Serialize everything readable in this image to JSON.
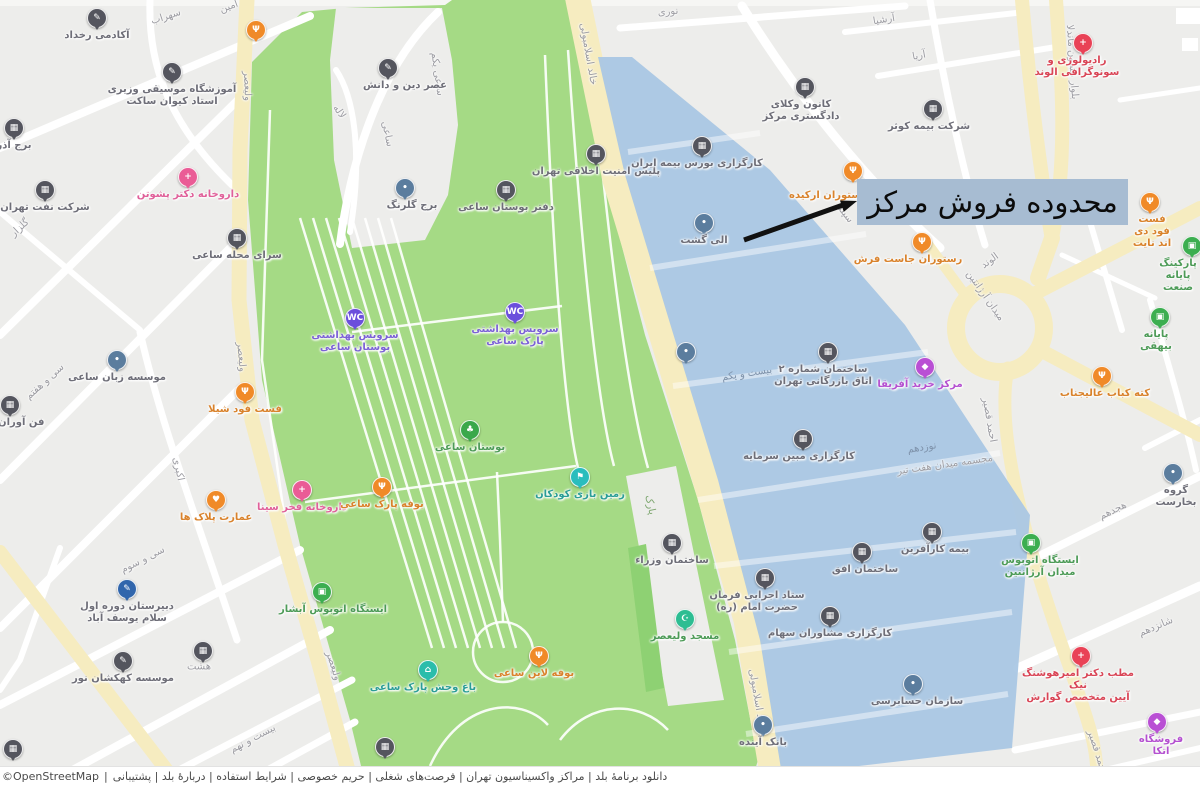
{
  "annotation": {
    "label": "محدوده فروش مرکز"
  },
  "footer": {
    "attribution": "©OpenStreetMap",
    "separator": "|",
    "links": [
      "دانلود برنامهٔ بلد",
      "مراکز واکسیناسیون تهران",
      "فرصت‌های شغلی",
      "حریم خصوصی",
      "شرایط استفاده",
      "دربارهٔ بلد",
      "پشتیبانی"
    ]
  },
  "colors": {
    "map_background": "#ededeb",
    "street_white": "#ffffff",
    "road_yellow": "#f6ecc0",
    "park_green": "#a5da85",
    "park_green_dark": "#8ed173",
    "highlight_blue": "#aac7e4",
    "annotation_background": "#a7bcd2",
    "arrow_black": "#111111"
  },
  "map": {
    "marker_types": {
      "building": {
        "color": "#54555e",
        "glyph": "▦"
      },
      "school": {
        "color": "#54555e",
        "glyph": "✎"
      },
      "generic": {
        "color": "#5b7d9e",
        "glyph": "•"
      },
      "blue": {
        "color": "#3166ac",
        "glyph": "✎"
      },
      "wc": {
        "color": "#6b4fdc",
        "glyph": "WC"
      },
      "shopping": {
        "color": "#b94fd4",
        "glyph": "◆"
      },
      "food": {
        "color": "#f08a28",
        "glyph": "Ψ"
      },
      "heart": {
        "color": "#f08a28",
        "glyph": "♥"
      },
      "pharmacy": {
        "color": "#ea5c96",
        "glyph": "+"
      },
      "medical": {
        "color": "#e94256",
        "glyph": "+"
      },
      "bus": {
        "color": "#3cae50",
        "glyph": "▣"
      },
      "tree": {
        "color": "#3aa84b",
        "glyph": "♣"
      },
      "mosque": {
        "color": "#2dbd92",
        "glyph": "☪"
      },
      "teal": {
        "color": "#2abdbd",
        "glyph": "⚑"
      },
      "zoo": {
        "color": "#2abdab",
        "glyph": "⌂"
      }
    },
    "markers": [
      {
        "n": "academy-rokhdad",
        "t": "school",
        "x": 97,
        "y": 18,
        "l": "آکادمی رخداد"
      },
      {
        "n": "vaziri-music-school",
        "t": "school",
        "x": 172,
        "y": 72,
        "l": "آموزشگاه موسیقی وزیری\nاستاد کیوان ساکت"
      },
      {
        "n": "restaurant-pin",
        "t": "food",
        "x": 256,
        "y": 30
      },
      {
        "n": "azar-tower",
        "t": "building",
        "x": 14,
        "y": 128,
        "l": "برج آذر"
      },
      {
        "n": "oil-company",
        "t": "building",
        "x": 45,
        "y": 190,
        "l": "شرکت نفت تهران"
      },
      {
        "n": "pashootan-pharmacy",
        "t": "pharmacy",
        "x": 188,
        "y": 177,
        "l": "داروخانه دکتر پشوتن"
      },
      {
        "n": "saee-neighborhood-house",
        "t": "building",
        "x": 237,
        "y": 238,
        "l": "سرای محله ساعی"
      },
      {
        "n": "asre-din-danesh-school",
        "t": "school",
        "x": 388,
        "y": 68,
        "l": "عصر دین و دانش",
        "lx": 405
      },
      {
        "n": "golrang-tower",
        "t": "generic",
        "x": 405,
        "y": 188,
        "l": "برج گلرنگ",
        "lx": 412
      },
      {
        "n": "saee-park-office",
        "t": "building",
        "x": 506,
        "y": 190,
        "l": "دفتر بوستان ساعی"
      },
      {
        "n": "moral-security-police",
        "t": "building",
        "x": 596,
        "y": 154,
        "l": "پلیس امنیت اخلاقی تهران"
      },
      {
        "n": "restroom-west",
        "t": "wc",
        "x": 355,
        "y": 318,
        "l": "سرویس بهداشتی\nبوستان ساعی"
      },
      {
        "n": "restroom-east",
        "t": "wc",
        "x": 515,
        "y": 312,
        "l": "سرویس بهداشتی\nپارک ساعی"
      },
      {
        "n": "saee-language-institute",
        "t": "generic",
        "x": 117,
        "y": 360,
        "l": "موسسه زبان ساعی"
      },
      {
        "n": "fanavaran",
        "t": "building",
        "x": 10,
        "y": 405,
        "l": "فن آوران مهر"
      },
      {
        "n": "shila-fastfood",
        "t": "food",
        "x": 245,
        "y": 392,
        "l": "فست فود شیلا"
      },
      {
        "n": "saee-garden",
        "t": "tree",
        "x": 470,
        "y": 430,
        "l": "بوستان ساعی"
      },
      {
        "n": "pelak-mansion",
        "t": "heart",
        "x": 216,
        "y": 500,
        "l": "عمارت پلاک ها"
      },
      {
        "n": "fakhre-sina-pharmacy",
        "t": "pharmacy",
        "x": 302,
        "y": 490,
        "l": "داروخانه فخر سینا"
      },
      {
        "n": "park-buffet",
        "t": "food",
        "x": 382,
        "y": 487,
        "l": "بوفه پارک ساعی"
      },
      {
        "n": "children-playground",
        "t": "teal",
        "x": 580,
        "y": 477,
        "l": "زمین بازی کودکان"
      },
      {
        "n": "abshar-bus-stop",
        "t": "bus",
        "x": 322,
        "y": 592,
        "l": "ایستگاه اتوبوس آبشار",
        "lx": 333
      },
      {
        "n": "salam-school",
        "t": "blue",
        "x": 127,
        "y": 589,
        "l": "دبیرستان دوره اول\nسلام یوسف آباد"
      },
      {
        "n": "kahkashan-institute",
        "t": "school",
        "x": 123,
        "y": 661,
        "l": "موسسه کهکشان نور"
      },
      {
        "n": "building-pin-hasht",
        "t": "building",
        "x": 203,
        "y": 651
      },
      {
        "n": "building-pin-corner",
        "t": "building",
        "x": 13,
        "y": 749
      },
      {
        "n": "saee-zoo",
        "t": "zoo",
        "x": 428,
        "y": 670,
        "l": "باغ وحش پارک ساعی",
        "lx": 423
      },
      {
        "n": "line-buffet",
        "t": "food",
        "x": 539,
        "y": 656,
        "l": "بوفه لاین ساعی",
        "lx": 534
      },
      {
        "n": "building-pin-park",
        "t": "building",
        "x": 385,
        "y": 747
      },
      {
        "n": "valiasr-mosque",
        "t": "mosque",
        "x": 685,
        "y": 619,
        "l": "مسجد ولیعصر"
      },
      {
        "n": "vozara-building",
        "t": "building",
        "x": 672,
        "y": 543,
        "l": "ساختمان وزراء"
      },
      {
        "n": "insurance-brokerage",
        "t": "building",
        "x": 702,
        "y": 146,
        "l": "کارگزاری بورس بیمه ایران",
        "lx": 697
      },
      {
        "n": "eligasht",
        "t": "generic",
        "x": 704,
        "y": 223,
        "l": "الی گشت"
      },
      {
        "n": "generic-pin",
        "t": "generic",
        "x": 686,
        "y": 352
      },
      {
        "n": "chamber-of-commerce",
        "t": "building",
        "x": 828,
        "y": 352,
        "l": "ساختمان شماره ۲\nاتاق بازرگانی تهران",
        "lx": 823
      },
      {
        "n": "africa-mall",
        "t": "shopping",
        "x": 925,
        "y": 367,
        "l": "مرکز خرید آفریقا",
        "lx": 920
      },
      {
        "n": "mobin-brokerage",
        "t": "building",
        "x": 803,
        "y": 439,
        "l": "کارگزاری مبین سرمایه",
        "lx": 799
      },
      {
        "n": "karafarin-insurance",
        "t": "building",
        "x": 932,
        "y": 532,
        "l": "بیمه کارآفرین",
        "lx": 935
      },
      {
        "n": "ofogh-building",
        "t": "building",
        "x": 862,
        "y": 552,
        "l": "ساختمان افق",
        "lx": 865
      },
      {
        "n": "setad-ejraei",
        "t": "building",
        "x": 765,
        "y": 578,
        "l": "ستاد اجرایی فرمان\nحضرت امام (ره)",
        "lx": 757
      },
      {
        "n": "moshaveran-brokerage",
        "t": "building",
        "x": 830,
        "y": 616,
        "l": "کارگزاری مشاوران سهام"
      },
      {
        "n": "audit-organization",
        "t": "generic",
        "x": 913,
        "y": 684,
        "l": "سازمان حسابرسی",
        "lx": 917
      },
      {
        "n": "ayandeh-bank",
        "t": "generic",
        "x": 763,
        "y": 725,
        "l": "بانک آینده"
      },
      {
        "n": "bar-association",
        "t": "building",
        "x": 805,
        "y": 87,
        "l": "کانون وکلای\nدادگستری مرکز",
        "lx": 801
      },
      {
        "n": "orchid-restaurant",
        "t": "food",
        "x": 853,
        "y": 171,
        "l": "رستوران ارکیده",
        "lx": 828,
        "ly": 190
      },
      {
        "n": "just-restaurant",
        "t": "food",
        "x": 922,
        "y": 242,
        "l": "رستوران جاست فرش",
        "lx": 908
      },
      {
        "n": "day-night-fastfood",
        "t": "food",
        "x": 1150,
        "y": 202,
        "l": "فست فود دی اند نایت",
        "lx": 1152
      },
      {
        "n": "alvand-radiology",
        "t": "medical",
        "x": 1083,
        "y": 43,
        "l": "رادیولوژی و\nسونوگرافی الوند",
        "lx": 1077
      },
      {
        "n": "kosar-insurance",
        "t": "building",
        "x": 933,
        "y": 109,
        "l": "شرکت بیمه کوثر",
        "lx": 929
      },
      {
        "n": "sanat-terminal",
        "t": "bus",
        "x": 1192,
        "y": 246,
        "l": "پارکینگ پایانه\nصنعت",
        "lx": 1178
      },
      {
        "n": "beyhaghi-terminal",
        "t": "bus",
        "x": 1160,
        "y": 317,
        "l": "پایانه بیهقی",
        "lx": 1156
      },
      {
        "n": "alijanab-kabab",
        "t": "food",
        "x": 1102,
        "y": 376,
        "l": "کته کباب عالیجناب",
        "lx": 1105
      },
      {
        "n": "bucharest-group",
        "t": "generic",
        "x": 1173,
        "y": 473,
        "l": "گروه بخارست",
        "lx": 1176
      },
      {
        "n": "argentine-bus-stop",
        "t": "bus",
        "x": 1031,
        "y": 543,
        "l": "ایستگاه اتوبوس\nمیدان آرژانتین",
        "lx": 1040
      },
      {
        "n": "doctor-office",
        "t": "medical",
        "x": 1081,
        "y": 656,
        "l": "مطب دکتر امیرهوشنگ نیک\nآیین متخصص گوارش",
        "lx": 1078
      },
      {
        "n": "etka-store",
        "t": "shopping",
        "x": 1157,
        "y": 722,
        "l": "فروشگاه اتکا",
        "lx": 1161
      }
    ],
    "street_labels": [
      {
        "t": "سهراب",
        "x": 166,
        "y": 17,
        "r": -18
      },
      {
        "t": "امین",
        "x": 229,
        "y": 7,
        "r": -20
      },
      {
        "t": "ولیعصر",
        "x": 247,
        "y": 86,
        "r": 88
      },
      {
        "t": "ولیعصر",
        "x": 241,
        "y": 357,
        "r": 85
      },
      {
        "t": "ولیعصر",
        "x": 333,
        "y": 666,
        "r": 72
      },
      {
        "t": "گلزار",
        "x": 20,
        "y": 228,
        "r": -42
      },
      {
        "t": "لاله",
        "x": 339,
        "y": 112,
        "r": 55
      },
      {
        "t": "ساعی",
        "x": 387,
        "y": 134,
        "r": 78
      },
      {
        "t": "ساعی یکم",
        "x": 437,
        "y": 74,
        "r": 82
      },
      {
        "t": "خالد اسلامبولی",
        "x": 588,
        "y": 54,
        "r": 80
      },
      {
        "t": "خالد اسلامبولی",
        "x": 757,
        "y": 700,
        "r": 80
      },
      {
        "t": "نوری",
        "x": 668,
        "y": 12,
        "r": -5
      },
      {
        "t": "آرشیا",
        "x": 884,
        "y": 20,
        "r": -9
      },
      {
        "t": "آریا",
        "x": 919,
        "y": 56,
        "r": -10
      },
      {
        "t": "بلوار نلسون ماندلا",
        "x": 1072,
        "y": 62,
        "r": 86
      },
      {
        "t": "سپند",
        "x": 845,
        "y": 214,
        "r": 52
      },
      {
        "t": "الوند",
        "x": 990,
        "y": 261,
        "r": -36
      },
      {
        "t": "میدان آرژانتین",
        "x": 985,
        "y": 296,
        "r": 55
      },
      {
        "t": "احمد قصیر",
        "x": 989,
        "y": 420,
        "r": 80
      },
      {
        "t": "احمد قصیر",
        "x": 1097,
        "y": 752,
        "r": 72
      },
      {
        "t": "بیست و یکم",
        "x": 747,
        "y": 374,
        "r": -9,
        "c": "onblue"
      },
      {
        "t": "نوزدهم",
        "x": 922,
        "y": 448,
        "r": -9,
        "c": "onblue"
      },
      {
        "t": "شانزدهم",
        "x": 1156,
        "y": 627,
        "r": -23
      },
      {
        "t": "هجدهم",
        "x": 1113,
        "y": 511,
        "r": -26
      },
      {
        "t": "بیست و نهم",
        "x": 253,
        "y": 739,
        "r": -28
      },
      {
        "t": "سی و سوم",
        "x": 143,
        "y": 560,
        "r": -27
      },
      {
        "t": "سی و هفتم",
        "x": 45,
        "y": 382,
        "r": -42
      },
      {
        "t": "اکبری",
        "x": 178,
        "y": 469,
        "r": 78
      },
      {
        "t": "هشت",
        "x": 199,
        "y": 667,
        "r": 0
      },
      {
        "t": "پارک",
        "x": 650,
        "y": 505,
        "r": 78,
        "c": "ongreen"
      },
      {
        "t": "مجسمه میدان هفت تیر",
        "x": 945,
        "y": 465,
        "r": -8
      }
    ]
  }
}
